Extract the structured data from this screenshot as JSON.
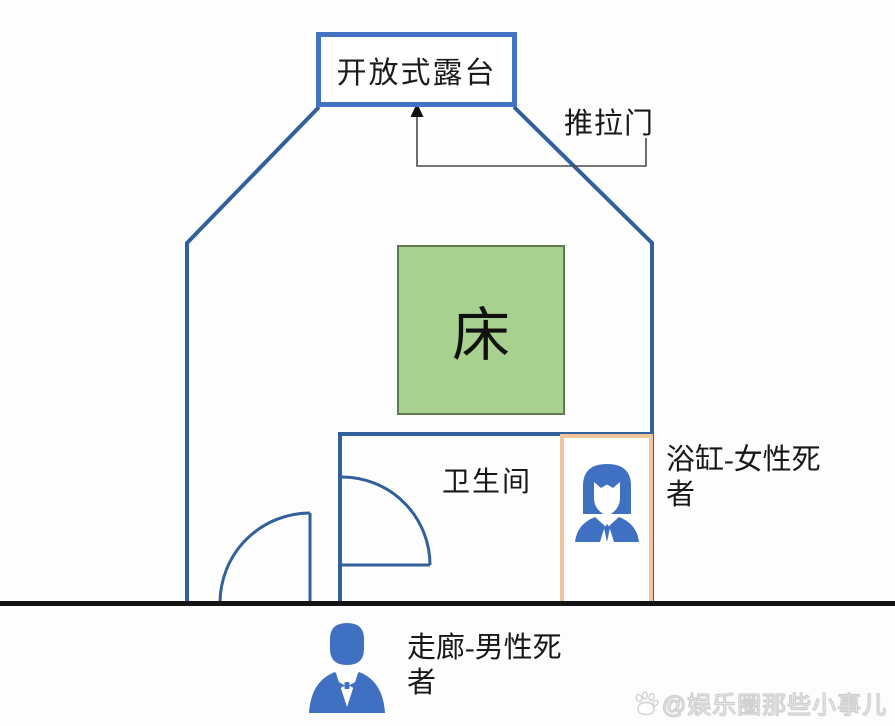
{
  "plan": {
    "terrace": {
      "label": "开放式露台"
    },
    "sliding_door": {
      "label": "推拉门"
    },
    "bed": {
      "label": "床"
    },
    "bathroom": {
      "label": "卫生间"
    },
    "bathtub": {
      "label": "浴缸-女性死者",
      "icon": "female-person-icon"
    },
    "corridor": {
      "label": "走廊-男性死者",
      "icon": "male-person-icon"
    }
  },
  "colors": {
    "wall_blue": "#31609b",
    "terrace_border_blue": "#4472c4",
    "bed_fill_green": "#a8d18f",
    "bed_border_green": "#5f7a50",
    "bathtub_border_orange": "#eec49c",
    "person_icon_blue": "#4070c1",
    "floor_black": "#141414",
    "connector_gray": "#4a4a4a"
  },
  "watermark": {
    "text": "@娱乐圈那些小事儿",
    "icon": "baidu-paw-icon"
  }
}
